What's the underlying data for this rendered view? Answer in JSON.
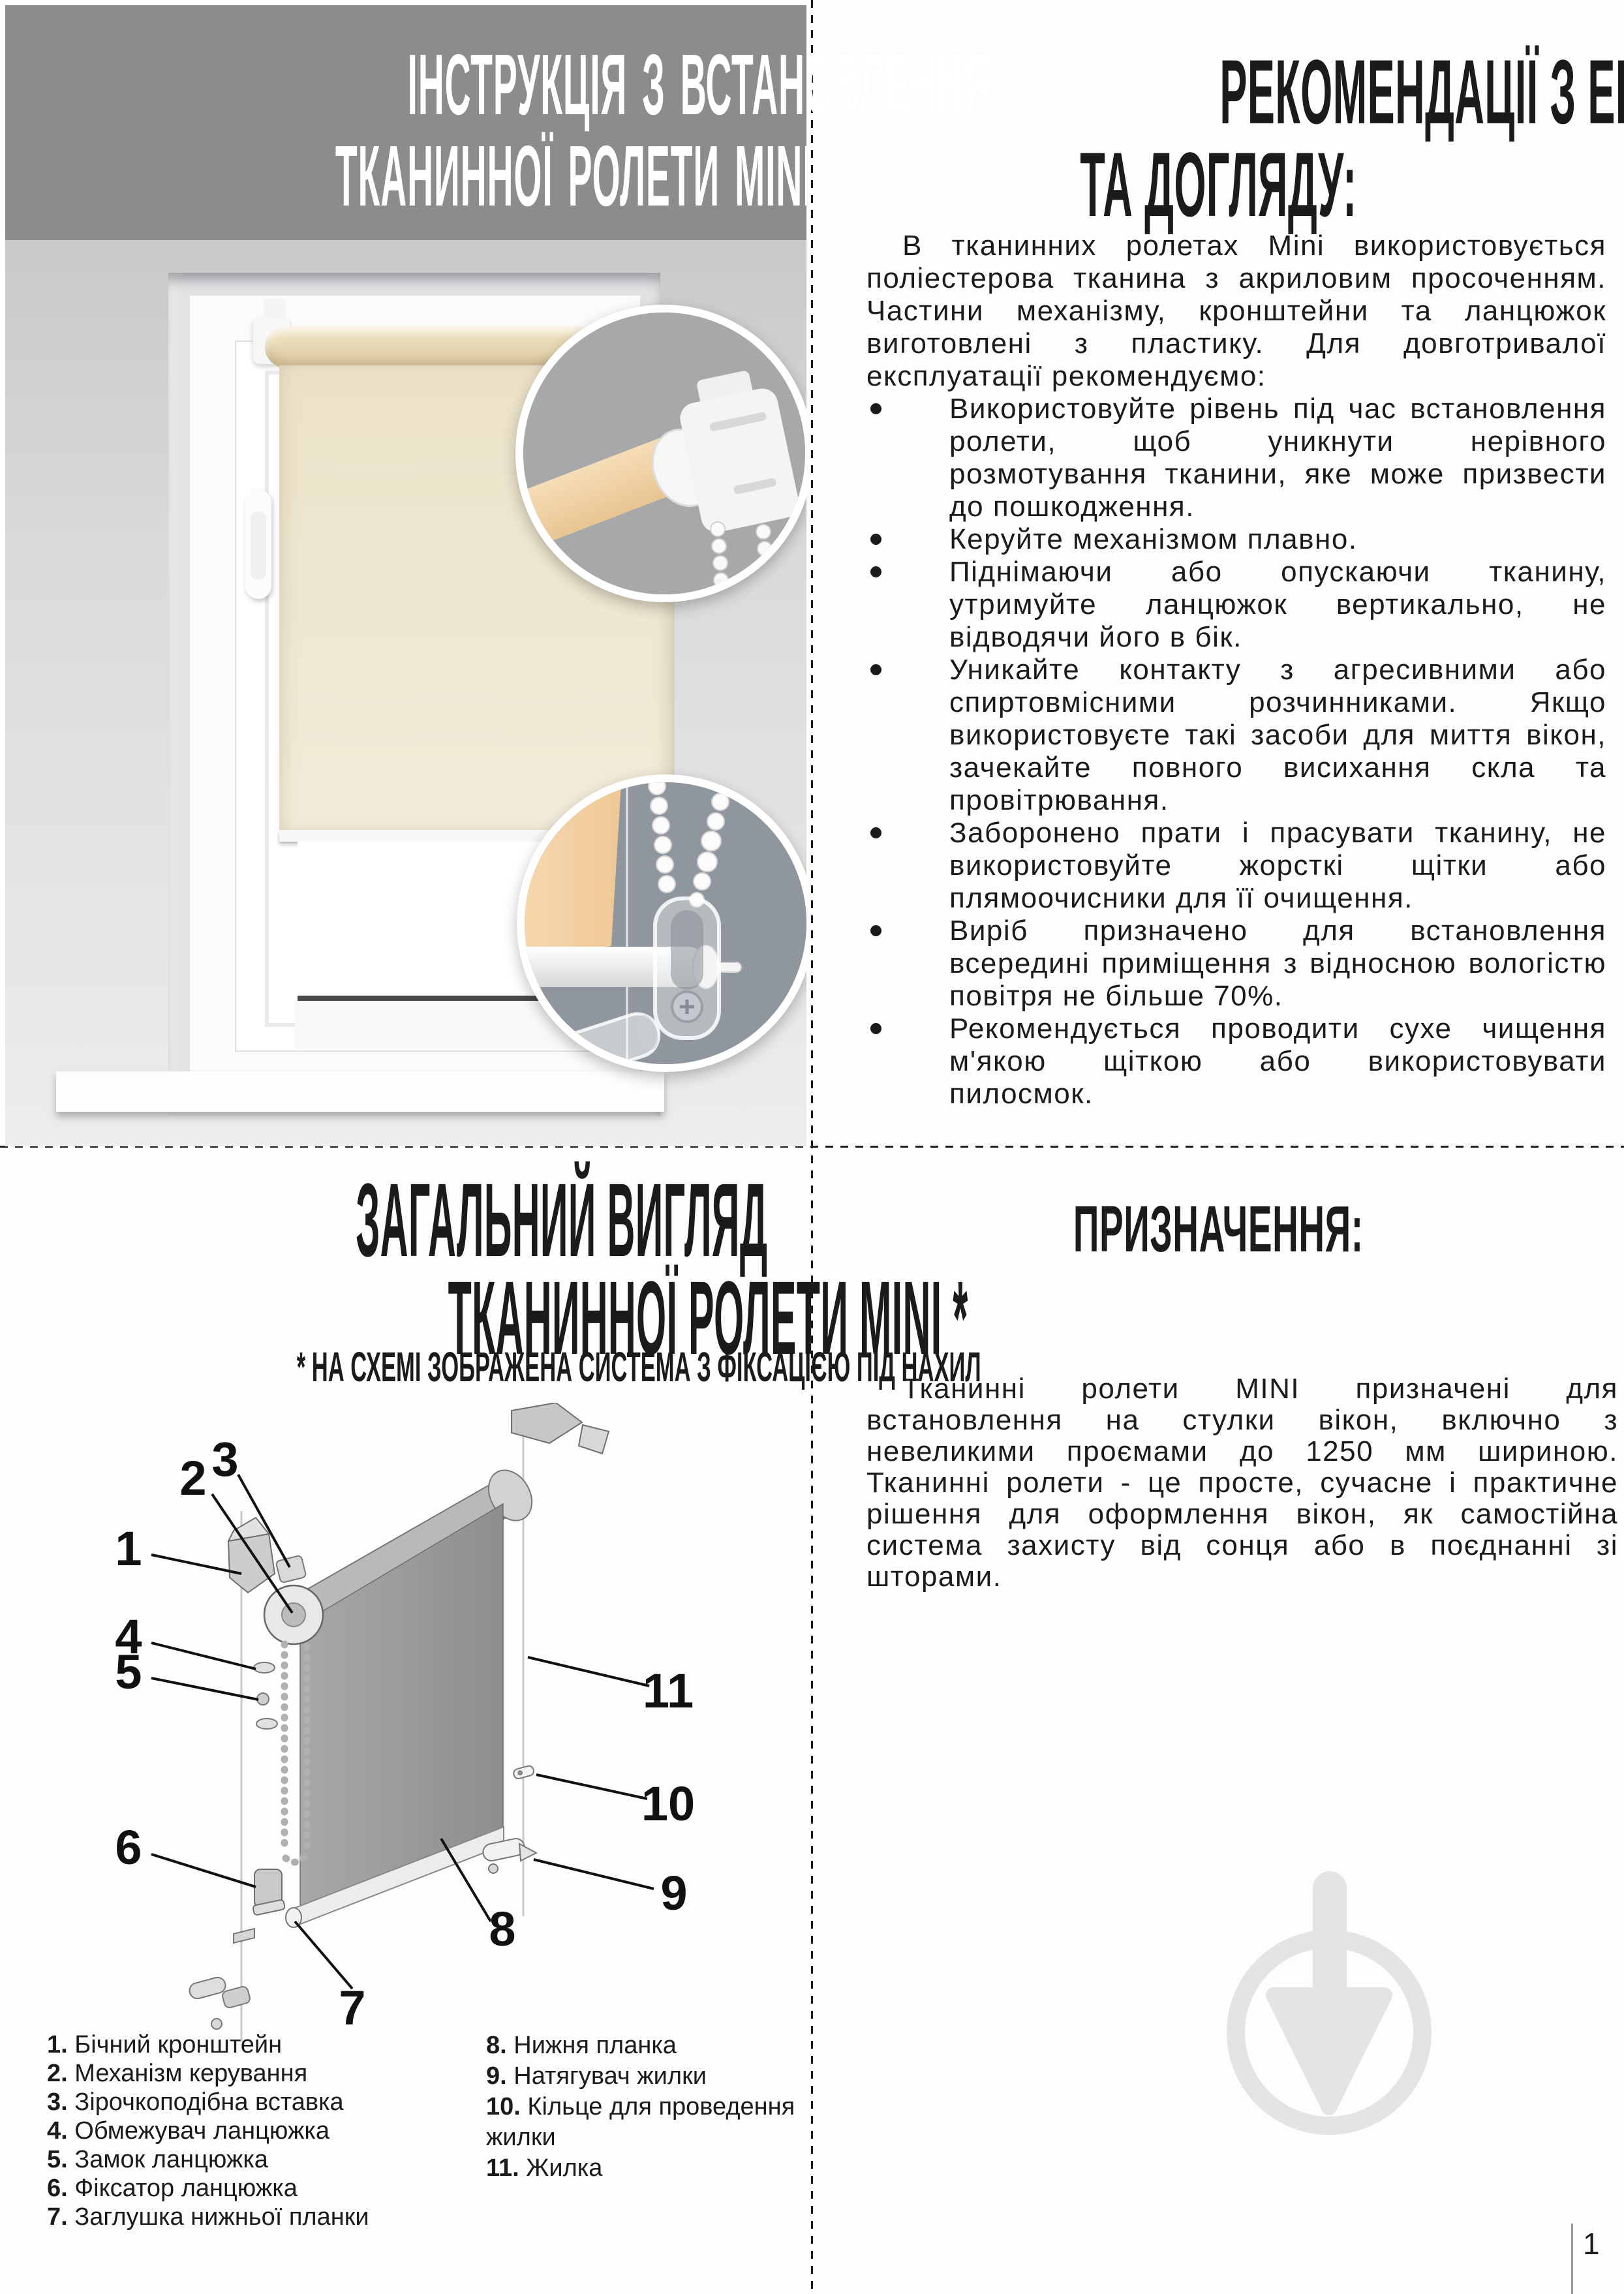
{
  "page": {
    "number": "1"
  },
  "header": {
    "title_line1": "ІНСТРУКЦІЯ З ВСТАНОВЛЕННЯ",
    "title_line2": "ТКАНИННОЇ РОЛЕТИ MINI"
  },
  "care": {
    "heading_line1": "РЕКОМЕНДАЦІЇ З ЕКСПЛУАТАЦІЇ",
    "heading_line2": "ТА ДОГЛЯДУ:",
    "intro": "В тканинних ролетах Mini використовується поліестерова тканина з акриловим просоченням. Частини механізму, кронштейни та ланцюжок виготовлені з пластику. Для довготривалої експлуатації рекомендуємо:",
    "bullets": [
      "Використовуйте рівень під час встановлення ролети, щоб уникнути нерівного розмотування тканини, яке може призвести до пошкодження.",
      "Керуйте механізмом плавно.",
      "Піднімаючи або опускаючи тканину, утримуйте ланцюжок вертикально, не відводячи його в бік.",
      "Уникайте контакту з агресивними або спиртовмісними розчинниками. Якщо використовуєте такі засоби для миття вікон, зачекайте повного висихання скла та провітрювання.",
      "Заборонено прати і прасувати тканину, не використовуйте жорсткі щітки або плямоочисники для її очищення.",
      "Виріб призначено для встановлення всередині приміщення з відносною вологістю повітря не більше 70%.",
      "Рекомендується проводити сухе чищення м'якою щіткою або використовувати пилосмок."
    ]
  },
  "overview": {
    "heading_line1": "ЗАГАЛЬНИЙ ВИГЛЯД",
    "heading_line2": "ТКАНИННОЇ РОЛЕТИ MINI *",
    "note": "* НА СХЕМІ ЗОБРАЖЕНА СИСТЕМА З ФІКСАЦІЄЮ ПІД НАХИЛ",
    "callouts": [
      "1",
      "2",
      "3",
      "4",
      "5",
      "6",
      "7",
      "8",
      "9",
      "10",
      "11"
    ],
    "legend_left": [
      {
        "num": "1.",
        "text": "Бічний кронштейн"
      },
      {
        "num": "2.",
        "text": "Механізм керування"
      },
      {
        "num": "3.",
        "text": "Зірочкоподібна вставка"
      },
      {
        "num": "4.",
        "text": "Обмежувач ланцюжка"
      },
      {
        "num": "5.",
        "text": "Замок ланцюжка"
      },
      {
        "num": "6.",
        "text": "Фіксатор ланцюжка"
      },
      {
        "num": "7.",
        "text": "Заглушка нижньої планки"
      }
    ],
    "legend_right": [
      {
        "num": "8.",
        "text": "Нижня планка"
      },
      {
        "num": "9.",
        "text": "Натягувач жилки"
      },
      {
        "num": "10.",
        "text": "Кільце для проведення жилки"
      },
      {
        "num": "11.",
        "text": "Жилка"
      }
    ]
  },
  "purpose": {
    "heading": "ПРИЗНАЧЕННЯ:",
    "body": "Тканинні ролети MINI призначені для встановлення на стулки вікон, включно з невеликими проємами до 1250 мм шириною. Тканинні ролети - це просте, сучасне і практичне рішення для оформлення вікон, як самостійна система захисту від сонця або в поєднанні зі шторами."
  },
  "colors": {
    "header_bg": "#8c8c8c",
    "text": "#1b1b1b",
    "fabric_beige": "#ece3ca",
    "tube_beige": "#ead8b0",
    "inset_top_bg": "#a6a8aa",
    "inset_bottom_bg": "#8f969d",
    "diagram_fabric": "#9c9c9c",
    "watermark": "#e4e4e4"
  }
}
